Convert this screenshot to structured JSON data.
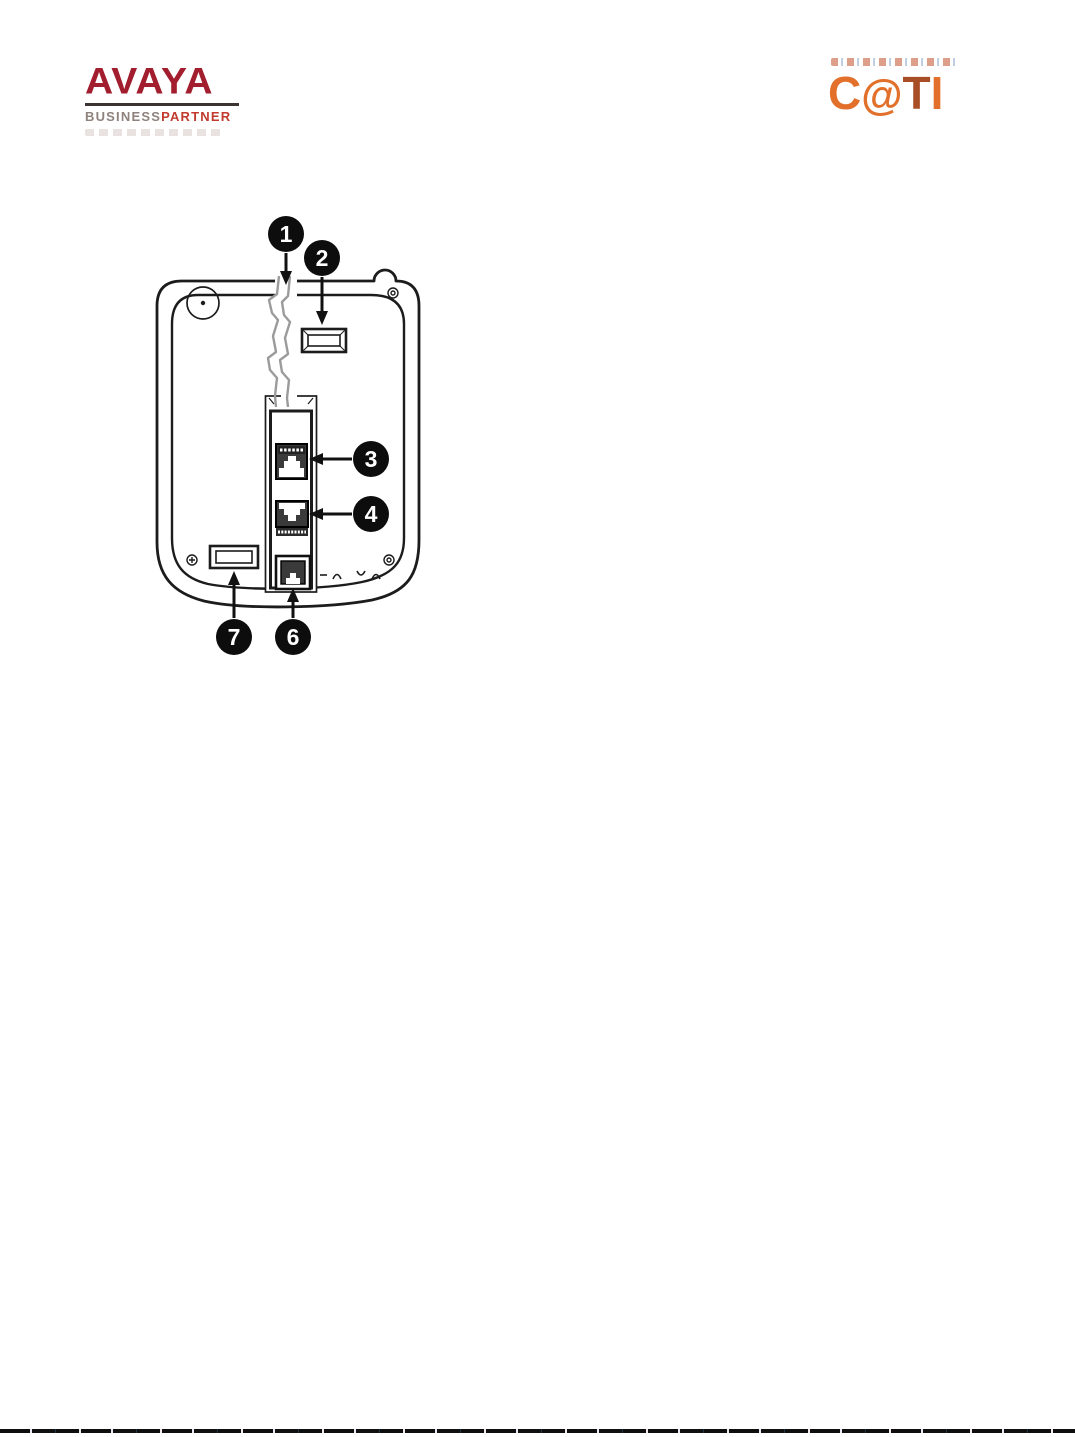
{
  "page": {
    "width": 1075,
    "height": 1437,
    "background": "#ffffff",
    "bottom_rule_color": "#0e0e0e"
  },
  "header": {
    "avaya": {
      "wordmark": "AVAYA",
      "sub_left": "BUSINESS",
      "sub_right": "PARTNER",
      "wordmark_color": "#a21d2d",
      "sub_left_color": "#8f827c",
      "sub_right_color": "#c23a2e",
      "rule_color": "#3b3430"
    },
    "cati": {
      "letters": [
        {
          "ch": "C",
          "color": "#e2702a"
        },
        {
          "ch": "@",
          "color": "#e2702a"
        },
        {
          "ch": "T",
          "color": "#a84e27"
        },
        {
          "ch": "I",
          "color": "#e2702a"
        }
      ]
    }
  },
  "diagram": {
    "subject": "telephone-base-rear-panel",
    "line_color": "#1c1c1c",
    "channel_color": "#9b9b9b",
    "port_fill": "#3a3a3a",
    "callouts": [
      {
        "n": "1",
        "points_to": "cable-routing-channel"
      },
      {
        "n": "2",
        "points_to": "upper-mounting-slot"
      },
      {
        "n": "3",
        "points_to": "upper-network-jack"
      },
      {
        "n": "4",
        "points_to": "middle-jack"
      },
      {
        "n": "6",
        "points_to": "bottom-handset-jack"
      },
      {
        "n": "7",
        "points_to": "lower-mounting-slot"
      }
    ]
  }
}
